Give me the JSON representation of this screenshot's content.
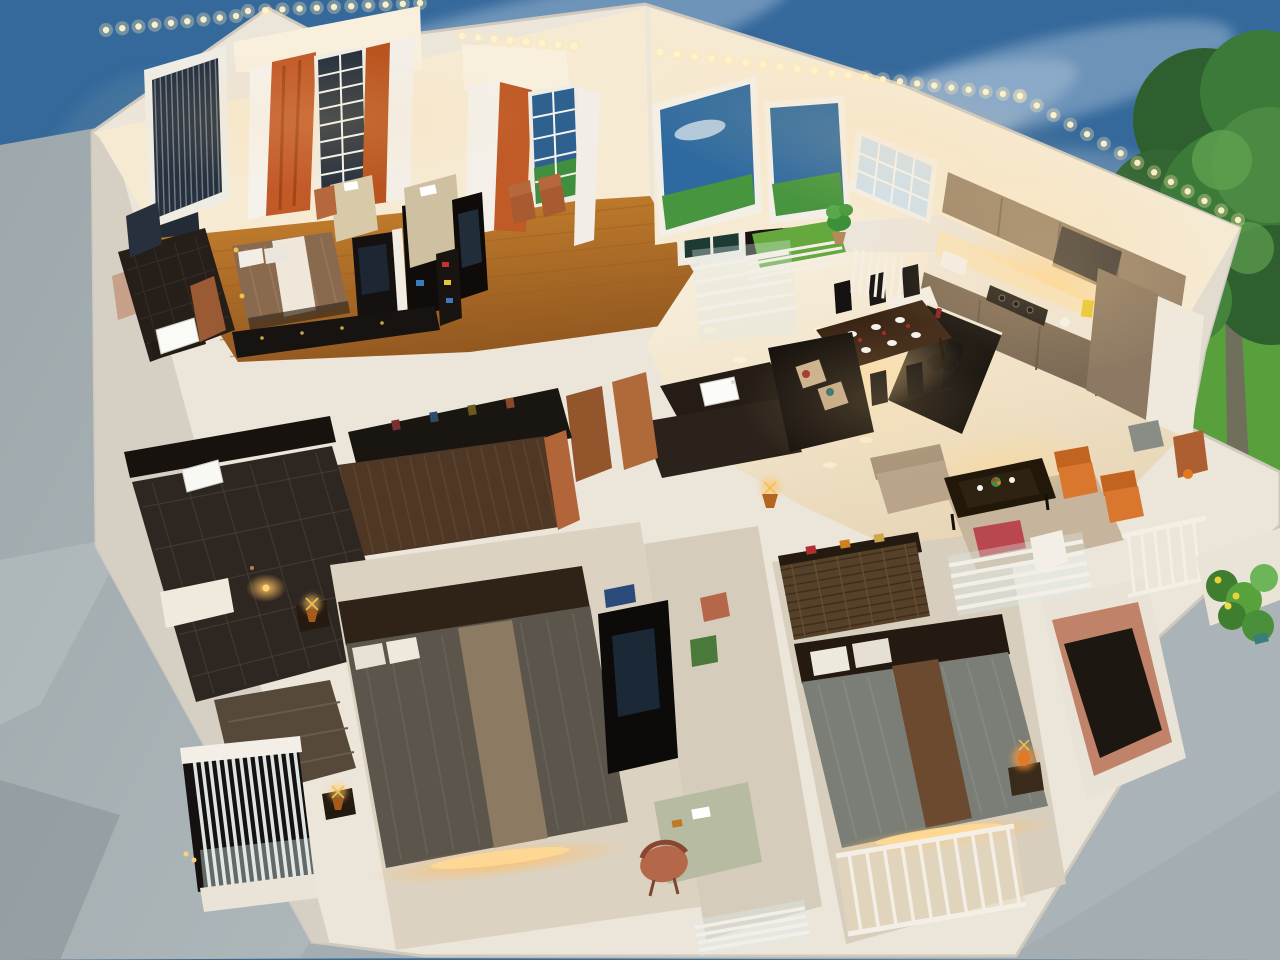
{
  "scene": {
    "type": "photograph",
    "subject": "Miniature architectural scale model of an apartment interior, cutaway dollhouse style, glowing with warm LED strip lighting",
    "setting": "Model placed on grey carpet in front of a painted backdrop of blue sky, clouds, lawn and a leafy tree",
    "camera": "High oblique view looking down into the open-top rooms"
  },
  "palette": {
    "sky": "#35699c",
    "skyEdge": "#4a7392",
    "cloud": "#e9f1f7",
    "lawn": "#58a03c",
    "lawnLight": "#8cc63f",
    "treeDark": "#2f5f2f",
    "tree": "#3c7a39",
    "treeLight": "#5ea04f",
    "trunk": "#6f6f5c",
    "carpet": "#a4aeb2",
    "carpetDark": "#8d989d",
    "modelBase": "#ece5da",
    "wallLit": "#f6ead3",
    "wallShadow": "#dcd5ca",
    "ledWarm": "#ffe9ad",
    "glowAmber": "#ffbe62",
    "wood": "#bf7a34",
    "gloss": "#f3e8d2",
    "charcoal": "#171310",
    "darkWood": "#241c15",
    "wardrobe": "#4e3724",
    "terracotta": "#ae5f31",
    "taupeCabinet": "#99836a",
    "taupeBase": "#7c6a56",
    "bedBrown": "#8a6a4e",
    "bedGrey3": "#5b554b",
    "bedGrey4": "#7b7e76",
    "runnerTan": "#8c7a62",
    "runnerBrown": "#6b4a30",
    "runnerWhite": "#efe8da",
    "turf": "#64a83e",
    "sofaTan": "#b9a48a",
    "accentOrange": "#d9772f",
    "salmonWall": "#c08268",
    "sage": "#b6bba2",
    "gold": "#f2c14e",
    "windowBlue": "#2e6aa0",
    "windowNight": "#27313d",
    "railWhite": "#f4efe6",
    "sinkWhite": "#fafaf7"
  },
  "lighting": {
    "strips": "Warm-white LED dot strips along the tops of the walls",
    "accents": "Amber under-bed and under-cabinet lighting",
    "pools": "Warm light pools reflecting on glossy tile floors"
  },
  "objects": [
    {
      "name": "master-bedroom",
      "desc": "Bedroom with wooden floor, double bed with brown duvet and white runner, TV divider and long low console"
    },
    {
      "name": "window-wall",
      "desc": "Back wall with grid windows, vertical-blind window, white sheers and orange curtains under an LED strip"
    },
    {
      "name": "en-suite-bathroom",
      "desc": "Small dark-floored bathroom with white washbasin and mirror"
    },
    {
      "name": "sitting-room",
      "desc": "Second room with terracotta chairs, writing desk, TV panel and colourful shelf"
    },
    {
      "name": "kitchen",
      "desc": "Open kitchen with taupe cabinets, lit counter, hob, appliances and tall units"
    },
    {
      "name": "breakfast-bar",
      "desc": "Black bar counter with swivel chair"
    },
    {
      "name": "dining-area",
      "desc": "Dark wood dining table set with white plates and red napkins, black chairs, glossy tile floor"
    },
    {
      "name": "balcony",
      "desc": "White railed balcony with artificial turf and a potted plant"
    },
    {
      "name": "hall-bathroom",
      "desc": "Hallway washbasin on a dark counter with timber doors"
    },
    {
      "name": "walk-in-closet",
      "desc": "Long dark-wood wardrobe with hanging clothes"
    },
    {
      "name": "dark-bathroom",
      "desc": "Stone-tiled bathroom with a dim warm accent light"
    },
    {
      "name": "staircase",
      "desc": "Stairwell with slatted railing and lit treads"
    },
    {
      "name": "bedroom-3",
      "desc": "Bedroom with textured grey bed, tan runner, brass lamps and under-bed lighting"
    },
    {
      "name": "study",
      "desc": "Study nook with TV wall, sage desk and terracotta chair"
    },
    {
      "name": "bedroom-4",
      "desc": "Bedroom with grey bed, brown runner, woven wardrobe, orange bedside lamp and railed balcony"
    },
    {
      "name": "living-room",
      "desc": "Lounge with beige sofas, orange armchairs and a dark coffee table under warm light"
    },
    {
      "name": "stair-railing",
      "desc": "White balustrade with round posts beside garden steps"
    },
    {
      "name": "garden",
      "desc": "Miniature plants with yellow flowers at the model edge"
    },
    {
      "name": "backdrop",
      "desc": "Painted blue sky with clouds, a lawn band and a leafy tree"
    },
    {
      "name": "carpet",
      "desc": "Grey carpet display surface"
    }
  ]
}
